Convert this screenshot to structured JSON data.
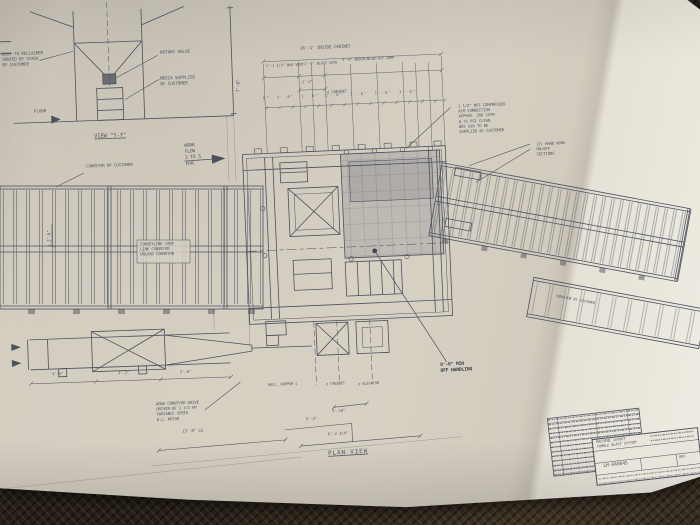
{
  "colors": {
    "ink": "#4c515e",
    "paper": "#d6d0c3",
    "paper_bright": "#ece9df",
    "table": "#262019",
    "pen": "#2e323a"
  },
  "detail_view": {
    "label": "VIEW \"Y-Y\"",
    "note_reclaim": "DUST TO RECLAIMER\nVENTED BY STACK\nBY CUSTOMER",
    "note_rotary": "ROTARY VALVE",
    "note_media": "MEDIA SUPPLIED\nBY CUSTOMER",
    "floor_label": "FLOOR",
    "dim_height": "7'-6\""
  },
  "work_flow": "WORK\nFLOW\n3 TO 5\nFPM",
  "conveyors": {
    "left_label": "CONVEYOR BY CUSTOMER",
    "right_label": "CONVEYOR BY CUSTOMER",
    "left_width_dim": "2'-6\"",
    "conveyline_note": "CONVEYLINE CORP.\nLINK CONVEYOR\nUNLOAD CONVEYOR",
    "drive_note": "WORK CONVEYOR DRIVE\nDRIVEN BY 1 1/2 HP\nVARIABLE SPEED\nD.C. MOTOR",
    "length_dim": "13'-0\" LG"
  },
  "cabinet": {
    "air_note": "1 1/2\" NPT COMPRESSED\nAIR CONNECTION\nAPPROX. 200 SCFM\n@ 75 PSI CLEAN\nDRY AIR TO BE\nSUPPLIED BY CUSTOMER",
    "hand_note": "(2) HAND WORK\nON/OFF\nSECTIONS",
    "pen_note": "8'-0\" MIN\nOFF HANDLING"
  },
  "dims_top": {
    "overall": "16'-1\" INSIDE CABINET",
    "seg_bag_vent": "2'-1 1/2\" BAG VENT",
    "seg_blast_gate": "1'-9\" BLAST GATE",
    "seg_brush": "5'-9\" BRUSH/BLOW-OFF COMP",
    "sub": "2'-2\"",
    "centerline": "¢ CABINET",
    "row": "6\"  1'-6\"  1'-6\"  1'-0\"  1'-6\"  1'-6\"  1'-6\""
  },
  "dims_bottom": {
    "cl_hopper": "RECL. HOPPER ¢",
    "cl_cabinet": "¢ CABINET",
    "cl_elevator": "¢ ELEVATOR",
    "d_3_10": "3'-10\"",
    "d_5_2": "5'-2\"",
    "d_6_2_3_4": "6'-2 3/4\"",
    "plan_label": "PLAN VIEW"
  },
  "elevation": {
    "d1": "4'-6\"",
    "d2": "3'-2\"",
    "d3": "2'-0\""
  },
  "title_block": {
    "title": "MACHINE LAYOUT\nTUMBLE BLAST SYSTEM",
    "drawing_number": "LH-040045",
    "rev_label": "REV"
  }
}
